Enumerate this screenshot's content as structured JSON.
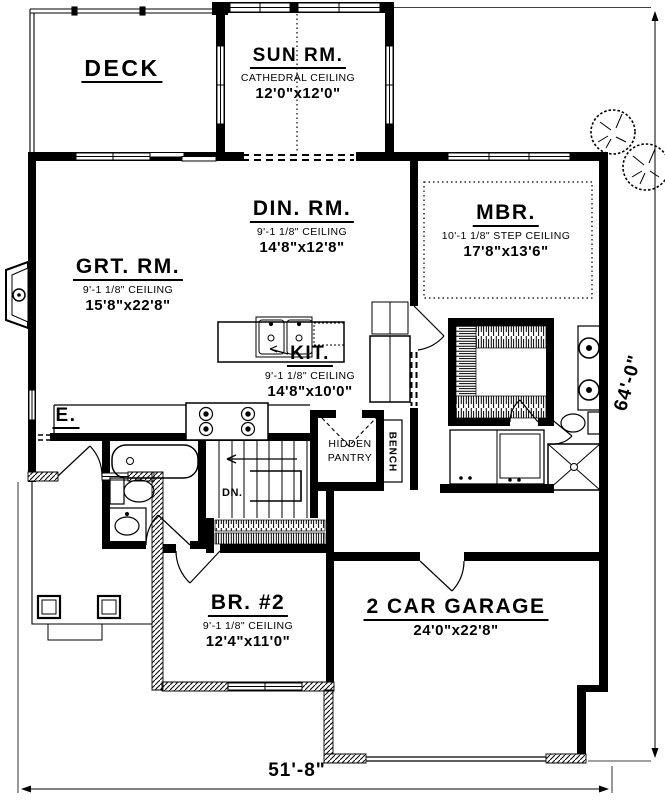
{
  "plan": {
    "rooms": [
      {
        "id": "deck",
        "name": "DECK",
        "ceiling": "",
        "size": ""
      },
      {
        "id": "sunroom",
        "name": "SUN RM.",
        "ceiling": "CATHEDRAL CEILING",
        "size": "12'0\"x12'0\""
      },
      {
        "id": "dining",
        "name": "DIN. RM.",
        "ceiling": "9'-1 1/8\" CEILING",
        "size": "14'8\"x12'8\""
      },
      {
        "id": "master-bedroom",
        "name": "MBR.",
        "ceiling": "10'-1 1/8\" STEP CEILING",
        "size": "17'8\"x13'6\""
      },
      {
        "id": "great-room",
        "name": "GRT. RM.",
        "ceiling": "9'-1 1/8\" CEILING",
        "size": "15'8\"x22'8\""
      },
      {
        "id": "kitchen",
        "name": "KIT.",
        "ceiling": "9'-1 1/8\" CEILING",
        "size": "14'8\"x10'0\""
      },
      {
        "id": "bedroom-2",
        "name": "BR. #2",
        "ceiling": "9'-1 1/8\" CEILING",
        "size": "12'4\"x11'0\""
      },
      {
        "id": "garage",
        "name": "2 CAR GARAGE",
        "ceiling": "",
        "size": "24'0\"x22'8\""
      }
    ],
    "labels": {
      "entry": "E.",
      "pantry_line1": "HIDDEN",
      "pantry_line2": "PANTRY",
      "bench": "BENCH",
      "stairs_down": "DN."
    },
    "dimensions": {
      "overall_depth": "64'-0\"",
      "overall_width": "51'-8\""
    },
    "colors": {
      "ink": "#000000",
      "paper": "#ffffff"
    }
  }
}
